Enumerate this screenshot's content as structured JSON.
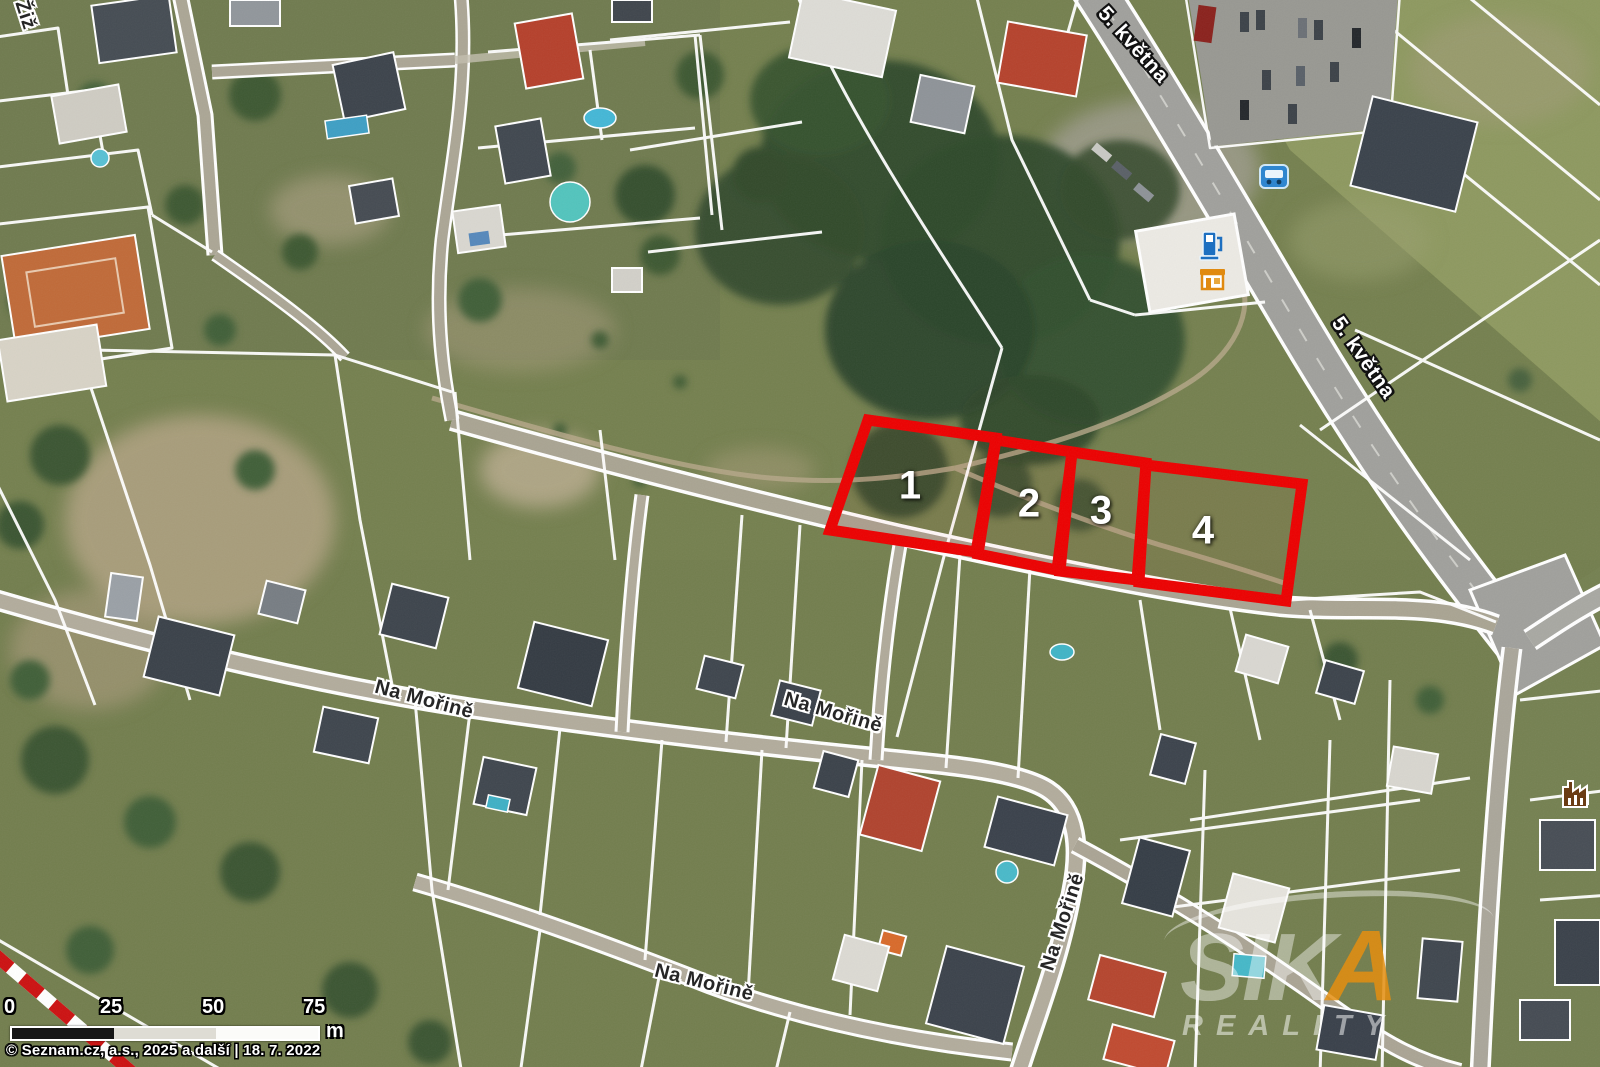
{
  "map": {
    "kind": "satellite cadastral map with highlighted plots",
    "colors": {
      "parcel_highlight": "#ec0000",
      "cadastral_line": "#ffffff",
      "major_label": "#ffffff",
      "minor_label": "#262626",
      "watermark_accent": "#e48e10",
      "scale_black": "#161616",
      "scale_mid": "#dedcd4",
      "scale_white": "#fbfbf9"
    }
  },
  "street_labels": [
    {
      "name": "5. května",
      "style": "major"
    },
    {
      "name": "5. května",
      "style": "major"
    },
    {
      "name": "Na Mořině",
      "style": "minor"
    },
    {
      "name": "Na Mořině",
      "style": "minor"
    },
    {
      "name": "Na Mořině",
      "style": "minor"
    },
    {
      "name": "Na Mořině",
      "style": "minor"
    },
    {
      "name": "Žiž",
      "style": "minor"
    }
  ],
  "parcels": [
    {
      "number": "1"
    },
    {
      "number": "2"
    },
    {
      "number": "3"
    },
    {
      "number": "4"
    }
  ],
  "poi_icons": [
    {
      "name": "bus-stop-icon"
    },
    {
      "name": "fuel-pump-icon"
    },
    {
      "name": "shop-icon"
    },
    {
      "name": "factory-icon"
    }
  ],
  "scale_bar": {
    "ticks": [
      "0",
      "25",
      "50",
      "75"
    ],
    "unit": "m"
  },
  "attribution": "© Seznam.cz, a.s., 2025 a další | 18. 7. 2022",
  "watermark": {
    "brand_top": "SIK",
    "brand_accent": "A",
    "brand_bottom": "REALITY"
  }
}
